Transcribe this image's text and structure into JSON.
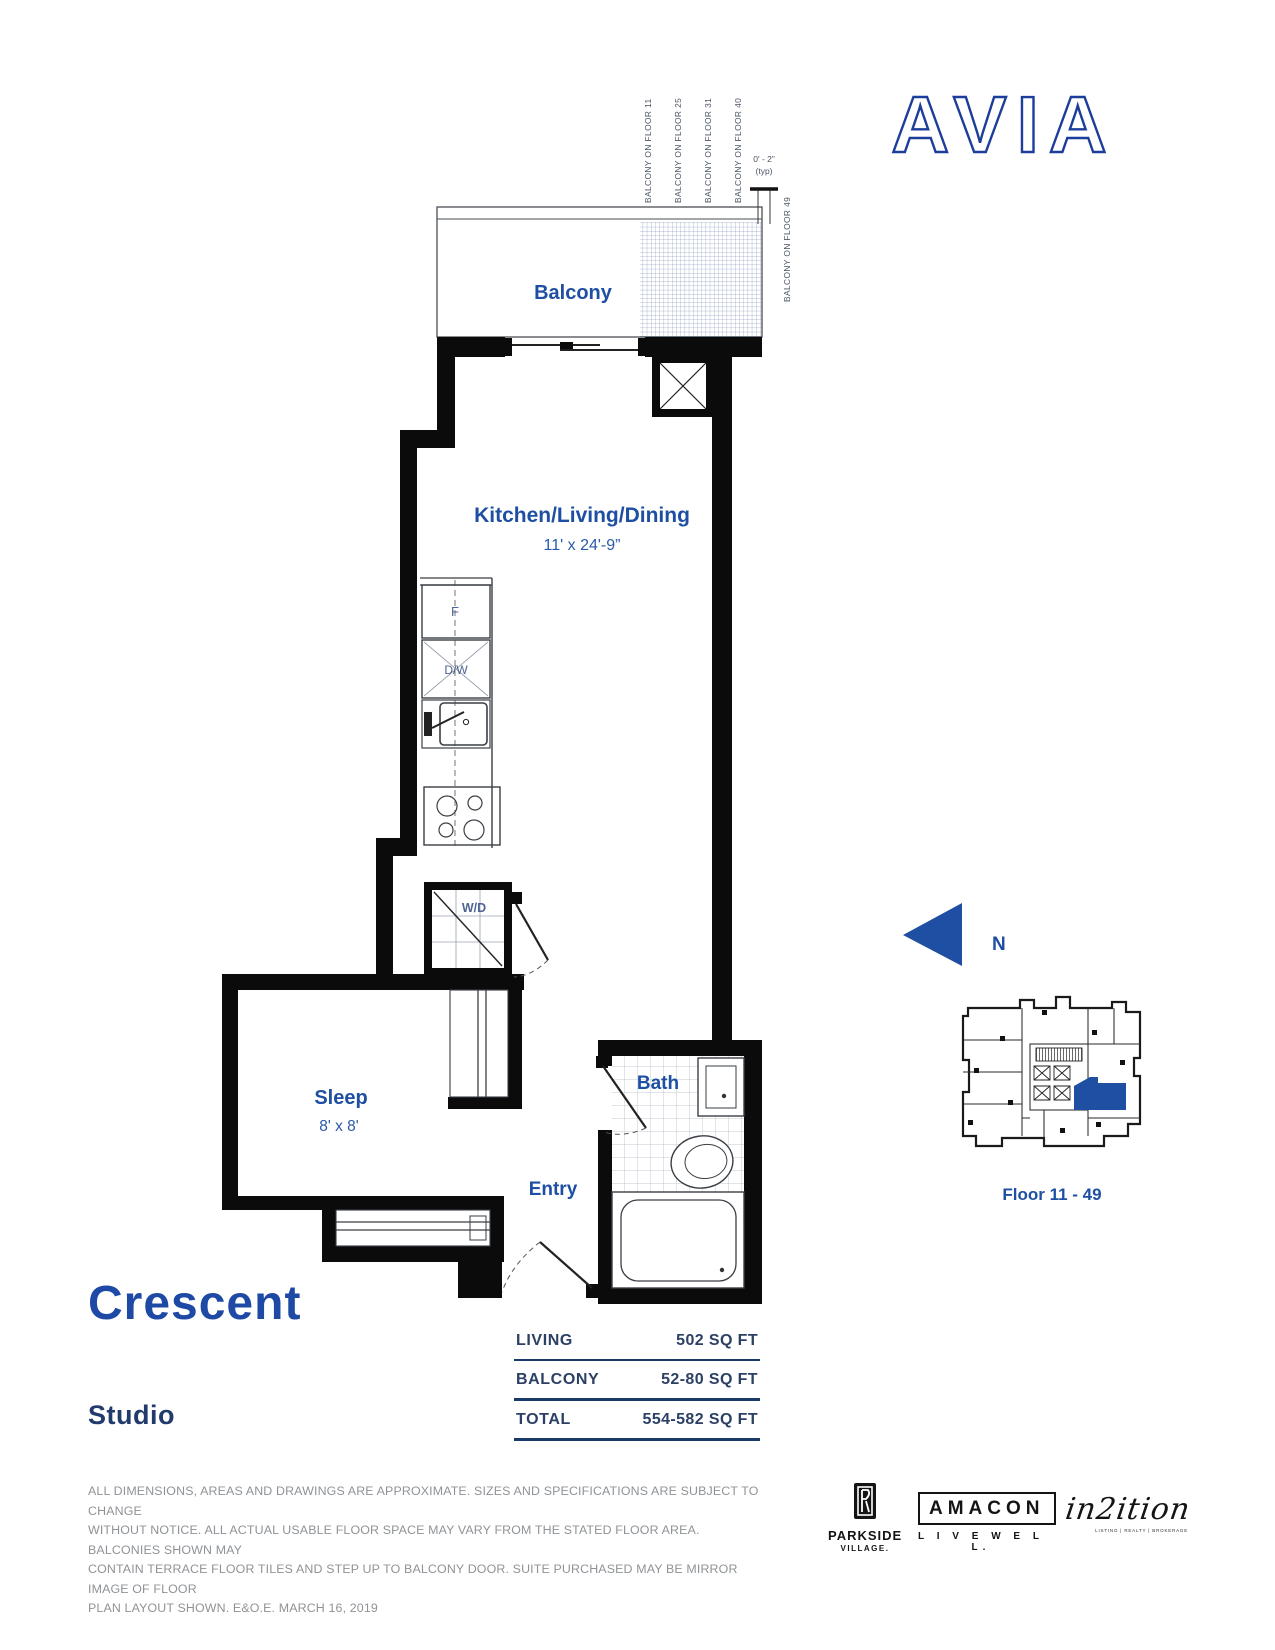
{
  "brand": {
    "logo": "AVIA"
  },
  "plan": {
    "balcony_label": "Balcony",
    "kld_label": "Kitchen/Living/Dining",
    "kld_dim": "11' x 24'-9”",
    "sleep_label": "Sleep",
    "sleep_dim": "8' x 8'",
    "bath_label": "Bath",
    "entry_label": "Entry",
    "fridge": "F",
    "dishwasher": "D/W",
    "washer_dryer": "W/D",
    "balcony_floor_labels": [
      "BALCONY ON FLOOR 11",
      "BALCONY ON FLOOR 25",
      "BALCONY ON FLOOR 31",
      "BALCONY ON FLOOR 40"
    ],
    "balcony_floor_49_label": "BALCONY ON FLOOR 49",
    "dim_note_value": "0' - 2”",
    "dim_note_typ": "(typ)"
  },
  "compass": {
    "north": "N"
  },
  "keyplan": {
    "caption": "Floor 11 - 49"
  },
  "unit": {
    "name": "Crescent",
    "type": "Studio"
  },
  "area_table": {
    "rows": [
      {
        "label": "LIVING",
        "value": "502 SQ FT"
      },
      {
        "label": "BALCONY",
        "value": "52-80 SQ FT"
      },
      {
        "label": "TOTAL",
        "value": "554-582 SQ FT"
      }
    ]
  },
  "disclaimer": {
    "lines": [
      "ALL DIMENSIONS, AREAS AND DRAWINGS ARE APPROXIMATE. SIZES AND SPECIFICATIONS ARE SUBJECT TO CHANGE",
      "WITHOUT NOTICE. ALL ACTUAL USABLE FLOOR SPACE MAY VARY FROM THE STATED FLOOR AREA. BALCONIES SHOWN MAY",
      "CONTAIN TERRACE FLOOR TILES AND STEP UP TO BALCONY DOOR. SUITE PURCHASED MAY BE MIRROR IMAGE OF FLOOR",
      "PLAN LAYOUT SHOWN. E&O.E. MARCH 16, 2019"
    ]
  },
  "logos": {
    "parkside_top": "PARKSIDE",
    "parkside_bottom": "VILLAGE.",
    "amacon": "AMACON",
    "amacon_tagline": "L I V E   W E L L.",
    "in2ition_script": "in2ition",
    "in2ition_tagline": "LISTING | REALTY | BROKERAGE"
  },
  "colors": {
    "navy": "#1c3d99",
    "blue": "#1e4fa3",
    "wall": "#0b0b0c",
    "gray_text": "#8f9397"
  }
}
